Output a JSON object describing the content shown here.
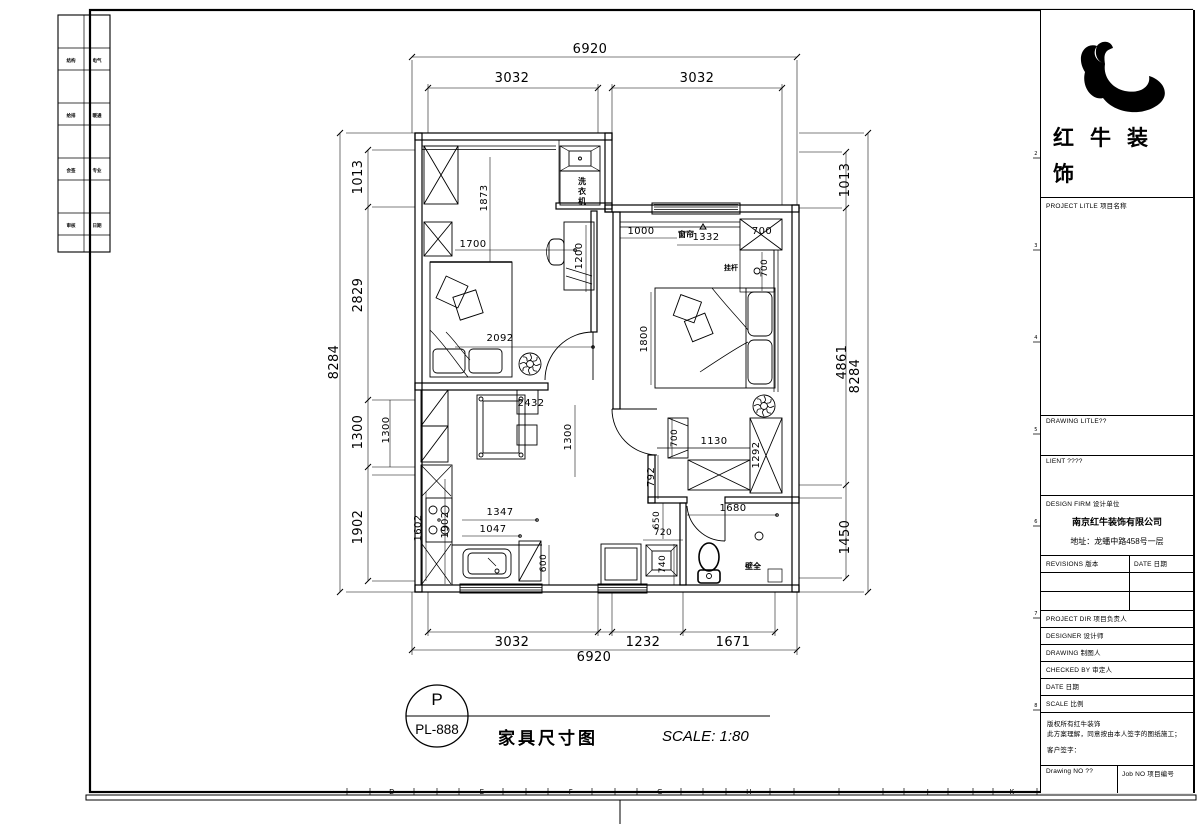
{
  "title_block": {
    "brand": "红牛装饰",
    "project_label": "PROJECT LITLE 项目名称",
    "drawing_label": "DRAWING LITLE??",
    "client_label": "LIENT ????",
    "design_firm_label": "DESIGN FIRM 设计单位",
    "company": "南京红牛装饰有限公司",
    "address": "地址：龙蟠中路458号一层",
    "revisions_label": "REVISIONS 版本",
    "date_col_label": "DATE 日期",
    "project_dir_label": "PROJECT DIR  项目负责人",
    "designer_label": "DESIGNER  设计师",
    "drawing_by_label": "DRAWING  制图人",
    "checked_by_label": "CHECKED BY  审定人",
    "date_label": "DATE  日期",
    "scale_label": "SCALE  比例",
    "copyright_line1": "版权所有红牛装饰",
    "copyright_line2": "此方案理解，同意按由本人签字的图纸施工；",
    "signature_label": "客户签字：",
    "drawing_no_label": "Drawing NO ??",
    "job_no_label": "Job NO 项目编号"
  },
  "drawing_label": {
    "number_top": "P",
    "number_bottom": "PL-888",
    "title": "家具尺寸图",
    "scale": "SCALE: 1:80"
  },
  "sheet": {
    "ruler_letters": [
      {
        "t": "D",
        "x": 392
      },
      {
        "t": "E",
        "x": 482
      },
      {
        "t": "F",
        "x": 571
      },
      {
        "t": "G",
        "x": 660
      },
      {
        "t": "H",
        "x": 749
      },
      {
        "t": "J",
        "x": 928
      },
      {
        "t": "K",
        "x": 1012
      }
    ],
    "frame_numbers": [
      {
        "t": "2",
        "y": 158
      },
      {
        "t": "3",
        "y": 250
      },
      {
        "t": "4",
        "y": 342
      },
      {
        "t": "5",
        "y": 434
      },
      {
        "t": "6",
        "y": 526
      },
      {
        "t": "7",
        "y": 618
      },
      {
        "t": "8",
        "y": 710
      }
    ],
    "strip_rows": [
      {
        "y": 62,
        "a": "结构",
        "b": "电气"
      },
      {
        "y": 117,
        "a": "给排",
        "b": "暖通"
      },
      {
        "y": 172,
        "a": "会签",
        "b": "专业"
      },
      {
        "y": 227,
        "a": "审核",
        "b": "日期"
      }
    ]
  },
  "plan": {
    "labels": [
      {
        "t": "6920",
        "x": 590,
        "y": 53,
        "fs": 13,
        "c": "dim"
      },
      {
        "t": "3032",
        "x": 512,
        "y": 82,
        "fs": 13,
        "c": "dim"
      },
      {
        "t": "3032",
        "x": 697,
        "y": 82,
        "fs": 13,
        "c": "dim"
      },
      {
        "t": "1013",
        "x": 362,
        "y": 177,
        "fs": 13,
        "r": 1,
        "c": "dim"
      },
      {
        "t": "2829",
        "x": 362,
        "y": 295,
        "fs": 13,
        "r": 1,
        "c": "dim"
      },
      {
        "t": "1300",
        "x": 362,
        "y": 432,
        "fs": 13,
        "r": 1,
        "c": "dim"
      },
      {
        "t": "1902",
        "x": 362,
        "y": 527,
        "fs": 13,
        "r": 1,
        "c": "dim"
      },
      {
        "t": "8284",
        "x": 338,
        "y": 362,
        "fs": 13,
        "r": 1,
        "c": "dim"
      },
      {
        "t": "1300",
        "x": 389,
        "y": 430,
        "fs": 10,
        "r": 1,
        "c": "dim"
      },
      {
        "t": "1602",
        "x": 421,
        "y": 528,
        "fs": 10,
        "r": 1,
        "c": "dim"
      },
      {
        "t": "1013",
        "x": 849,
        "y": 180,
        "fs": 13,
        "r": 1,
        "c": "dim"
      },
      {
        "t": "4861",
        "x": 846,
        "y": 362,
        "fs": 13,
        "r": 1,
        "c": "dim"
      },
      {
        "t": "8284",
        "x": 859,
        "y": 376,
        "fs": 13,
        "r": 1,
        "c": "dim"
      },
      {
        "t": "1450",
        "x": 849,
        "y": 537,
        "fs": 13,
        "r": 1,
        "c": "dim"
      },
      {
        "t": "3032",
        "x": 512,
        "y": 646,
        "fs": 13,
        "c": "dim"
      },
      {
        "t": "1232",
        "x": 643,
        "y": 646,
        "fs": 13,
        "c": "dim"
      },
      {
        "t": "1671",
        "x": 733,
        "y": 646,
        "fs": 13,
        "c": "dim"
      },
      {
        "t": "6920",
        "x": 594,
        "y": 661,
        "fs": 13,
        "c": "dim"
      },
      {
        "t": "1873",
        "x": 487,
        "y": 198,
        "fs": 10,
        "r": 1,
        "c": "dim"
      },
      {
        "t": "1700",
        "x": 473,
        "y": 247,
        "fs": 10,
        "c": "dim"
      },
      {
        "t": "1200",
        "x": 582,
        "y": 256,
        "fs": 10,
        "r": 1,
        "c": "dim"
      },
      {
        "t": "2092",
        "x": 500,
        "y": 341,
        "fs": 10,
        "c": "dim"
      },
      {
        "t": "2432",
        "x": 531,
        "y": 406,
        "fs": 10,
        "c": "dim"
      },
      {
        "t": "1300",
        "x": 571,
        "y": 437,
        "fs": 10,
        "r": 1,
        "c": "dim"
      },
      {
        "t": "1000",
        "x": 641,
        "y": 234,
        "fs": 10,
        "c": "dim"
      },
      {
        "t": "1332",
        "x": 706,
        "y": 240,
        "fs": 10,
        "c": "dim"
      },
      {
        "t": "700",
        "x": 762,
        "y": 234,
        "fs": 10,
        "c": "dim"
      },
      {
        "t": "700",
        "x": 767,
        "y": 268,
        "fs": 9,
        "r": 1,
        "c": "dim"
      },
      {
        "t": "1800",
        "x": 647,
        "y": 339,
        "fs": 10,
        "r": 1,
        "c": "dim"
      },
      {
        "t": "700",
        "x": 677,
        "y": 438,
        "fs": 9,
        "r": 1,
        "c": "dim"
      },
      {
        "t": "1130",
        "x": 714,
        "y": 444,
        "fs": 10,
        "c": "dim"
      },
      {
        "t": "1292",
        "x": 759,
        "y": 455,
        "fs": 10,
        "r": 1,
        "c": "dim"
      },
      {
        "t": "792",
        "x": 654,
        "y": 477,
        "fs": 10,
        "r": 1,
        "c": "dim"
      },
      {
        "t": "650",
        "x": 659,
        "y": 520,
        "fs": 9,
        "r": 1,
        "c": "dim"
      },
      {
        "t": "720",
        "x": 663,
        "y": 535,
        "fs": 9,
        "c": "dim"
      },
      {
        "t": "740",
        "x": 665,
        "y": 564,
        "fs": 9,
        "r": 1,
        "c": "dim"
      },
      {
        "t": "1680",
        "x": 733,
        "y": 511,
        "fs": 10,
        "c": "dim"
      },
      {
        "t": "1347",
        "x": 500,
        "y": 515,
        "fs": 10,
        "c": "dim"
      },
      {
        "t": "1047",
        "x": 493,
        "y": 532,
        "fs": 10,
        "c": "dim"
      },
      {
        "t": "600",
        "x": 546,
        "y": 563,
        "fs": 9,
        "r": 1,
        "c": "dim"
      },
      {
        "t": "1902",
        "x": 448,
        "y": 525,
        "fs": 10,
        "r": 1,
        "c": "dim"
      },
      {
        "t": "洗",
        "x": 582,
        "y": 184,
        "fs": 8,
        "c": "cn"
      },
      {
        "t": "衣",
        "x": 582,
        "y": 194,
        "fs": 8,
        "c": "cn"
      },
      {
        "t": "机",
        "x": 582,
        "y": 204,
        "fs": 8,
        "c": "cn"
      },
      {
        "t": "窗帘",
        "x": 686,
        "y": 237,
        "fs": 8,
        "c": "cn"
      },
      {
        "t": "挂杆",
        "x": 731,
        "y": 270,
        "fs": 7,
        "c": "cn"
      },
      {
        "t": "壁全",
        "x": 753,
        "y": 569,
        "fs": 8,
        "c": "cn"
      }
    ]
  }
}
